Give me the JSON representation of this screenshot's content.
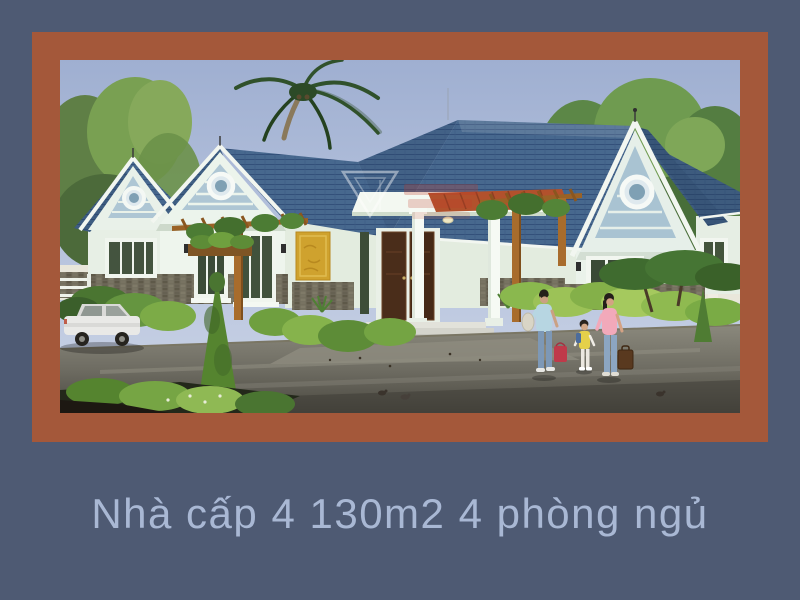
{
  "page": {
    "background_color": "#4e5a73",
    "frame_color": "#a4583a"
  },
  "caption": {
    "text": "Nhà cấp 4 130m2 4 phòng ngủ",
    "color": "#a9b8d4"
  },
  "photo": {
    "description": "3D exterior rendering of a single-story house: blue tiled roof with three gables and round vent windows, pale mint walls, stone wainscot, yellow accent panel, wooden pergolas, central porch with white columns and dark double doors, garden shrubs and topiary, white sedan at left, a woman and two children walking at right, palm and leafy trees behind, faint red logo watermark over the roof",
    "colors": {
      "sky": "#a9b6d4",
      "roof_tile": "#47688e",
      "wall": "#eef5ed",
      "stone": "#716c5c",
      "accent_panel": "#cfa22e",
      "wood": "#9a6226",
      "foliage": "#5d8c37",
      "road": "#6e6c62",
      "watermark_red": "#c23a28"
    }
  }
}
